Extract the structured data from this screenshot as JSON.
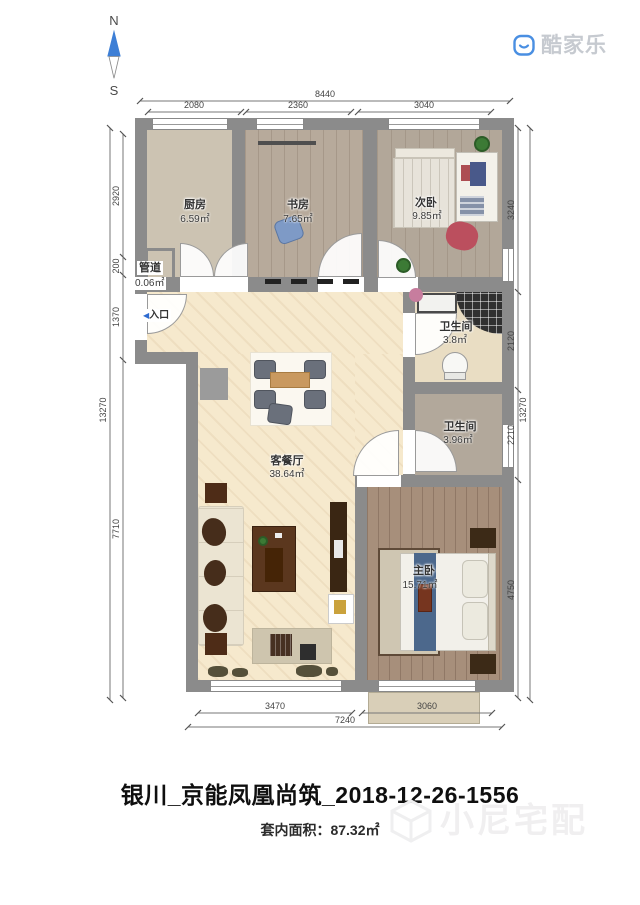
{
  "compass": {
    "north": "N",
    "south": "S"
  },
  "logo": {
    "name": "酷家乐"
  },
  "rooms": {
    "kitchen": {
      "name": "厨房",
      "area": "6.59㎡"
    },
    "study": {
      "name": "书房",
      "area": "7.65㎡"
    },
    "bedroom2": {
      "name": "次卧",
      "area": "9.85㎡"
    },
    "duct": {
      "name": "管道",
      "area": "0.06㎡"
    },
    "bath1": {
      "name": "卫生间",
      "area": "3.8㎡"
    },
    "bath2": {
      "name": "卫生间",
      "area": "3.96㎡"
    },
    "living": {
      "name": "客餐厅",
      "area": "38.64㎡"
    },
    "master": {
      "name": "主卧",
      "area": "15.71㎡"
    }
  },
  "entrance": {
    "arrow": "◀",
    "label": "入口"
  },
  "dimensions": {
    "top": {
      "total": "8440",
      "segments": [
        "2080",
        "2360",
        "3040"
      ]
    },
    "left": {
      "total": "13270",
      "segments": [
        "2920",
        "200",
        "1370",
        "7710"
      ]
    },
    "right": {
      "total": "13270",
      "segments": [
        "3240",
        "2120",
        "2210",
        "4750"
      ]
    },
    "bottom": {
      "total": "7240",
      "segments": [
        "3470",
        "3060"
      ]
    }
  },
  "footer": {
    "title": "银川_京能凤凰尚筑_2018-12-26-1556",
    "area_text": "套内面积：87.32㎡"
  },
  "watermark": {
    "text": "小尼宅配"
  },
  "colors": {
    "wall": "#8b8b8b",
    "accent_blue": "#3d7fd6",
    "living_floor": "#f6e9cd",
    "wood_floor": "#b2a799",
    "master_floor": "#a78f7b"
  }
}
